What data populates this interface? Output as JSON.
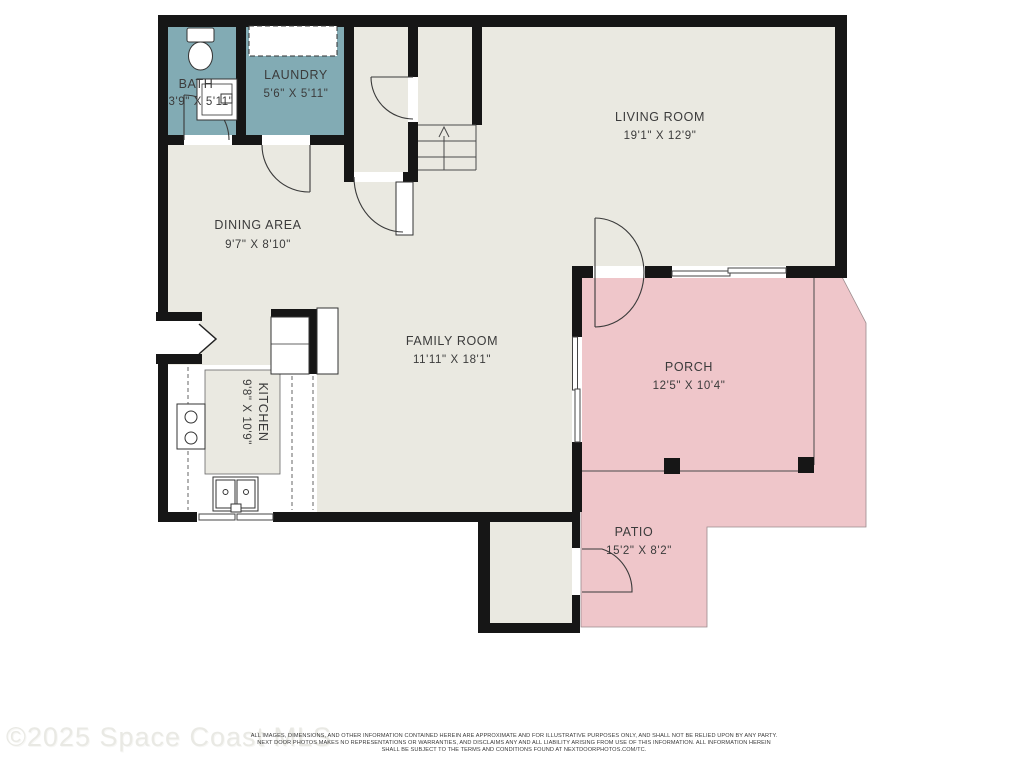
{
  "watermark": "©2025 Space Coast MLS",
  "disclaimer": {
    "line1": "ALL IMAGES, DIMENSIONS, AND OTHER INFORMATION CONTAINED HEREIN ARE APPROXIMATE AND FOR ILLUSTRATIVE PURPOSES ONLY, AND SHALL NOT BE RELIED UPON BY ANY PARTY.",
    "line2": "NEXT DOOR PHOTOS MAKES NO REPRESENTATIONS OR WARRANTIES, AND DISCLAIMS ANY AND ALL LIABILITY ARISING FROM USE OF THIS INFORMATION. ALL INFORMATION HEREIN",
    "line3": "SHALL BE SUBJECT TO THE TERMS AND CONDITIONS FOUND AT NEXTDOORPHOTOS.COM/TC."
  },
  "rooms": [
    {
      "name": "BATH",
      "dims": "3'9\" X 5'11\""
    },
    {
      "name": "LAUNDRY",
      "dims": "5'6\" X 5'11\""
    },
    {
      "name": "LIVING ROOM",
      "dims": "19'1\" X 12'9\""
    },
    {
      "name": "DINING AREA",
      "dims": "9'7\" X 8'10\""
    },
    {
      "name": "FAMILY ROOM",
      "dims": "11'11\" X 18'1\""
    },
    {
      "name": "KITCHEN",
      "dims": "9'8\" X 10'9\""
    },
    {
      "name": "PORCH",
      "dims": "12'5\" X 10'4\""
    },
    {
      "name": "PATIO",
      "dims": "15'2\" X 8'2\""
    }
  ],
  "colors": {
    "wall": "#161616",
    "floor": "#eae9e1",
    "wet_room": "#82abb4",
    "outdoor": "#efc6ca"
  }
}
